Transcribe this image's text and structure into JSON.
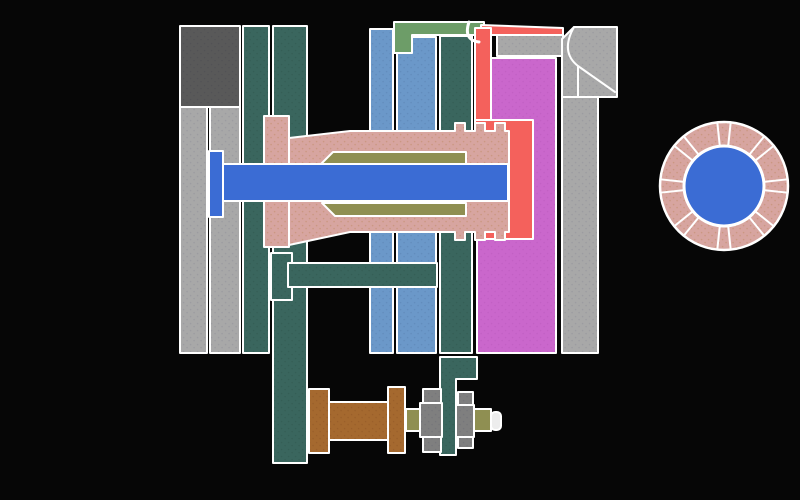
{
  "window": {
    "width": 800,
    "height": 500,
    "background": "#060606"
  },
  "palette": {
    "outline": "#ffffff",
    "dgray": "#595959",
    "lgray": "#a8a8a8",
    "teal": "#3a665e",
    "panelblue": "#6b98c9",
    "shaftblue": "#3b6cd4",
    "pink": "#d7a5a0",
    "olive": "#8f8f52",
    "green": "#6d9d68",
    "red": "#f4615c",
    "magenta": "#ca67cc",
    "brown": "#a5692f",
    "nutgray": "#7f7f7f",
    "darkred": "#330404",
    "cap": "#ededed",
    "circlepink": "#d7a5a0"
  },
  "texture_dots": {
    "pink": "#c08a64",
    "circlepink": "#c08a64",
    "lgray": "#8f8f98",
    "dgray": "#4b4b52",
    "teal": "#2f554d",
    "panelblue": "#5a82b2",
    "magenta": "#b95abb",
    "brown": "#8f5526",
    "nutgray": "#6e6e76"
  },
  "legend": {
    "name": "legend-box",
    "x": 9,
    "y": 17,
    "w": 88,
    "h": 49,
    "fill": "darkred",
    "stroke_width": 3
  },
  "cross_section": {
    "name": "mold-cross-section",
    "shapes": [
      {
        "name": "top-clamp-block",
        "fill": "dgray",
        "rect": [
          180,
          26,
          60,
          81
        ]
      },
      {
        "name": "back-plate-outer",
        "fill": "lgray",
        "rect": [
          180,
          107,
          27,
          246
        ]
      },
      {
        "name": "back-plate-inner",
        "fill": "lgray",
        "rect": [
          210,
          107,
          30,
          246
        ]
      },
      {
        "name": "riser-pillar-left",
        "fill": "teal",
        "rect": [
          243,
          26,
          26,
          327
        ]
      },
      {
        "name": "riser-pillar-mid",
        "fill": "teal",
        "rect": [
          273,
          26,
          34,
          437
        ]
      },
      {
        "name": "manifold-plate-left",
        "fill": "panelblue",
        "rect": [
          370,
          29,
          23,
          324
        ]
      },
      {
        "name": "manifold-plate-right",
        "fill": "panelblue",
        "rect": [
          397,
          37,
          39,
          316
        ]
      },
      {
        "name": "nozzle-retainer-column",
        "fill": "teal",
        "rect": [
          440,
          36,
          32,
          317
        ]
      },
      {
        "name": "top-seal-bar",
        "fill": "green",
        "poly": [
          [
            394,
            22
          ],
          [
            484,
            22
          ],
          [
            484,
            35
          ],
          [
            412,
            35
          ],
          [
            412,
            53
          ],
          [
            394,
            53
          ]
        ]
      },
      {
        "name": "top-gray-band",
        "fill": "lgray",
        "rect": [
          497,
          35,
          66,
          21
        ]
      },
      {
        "name": "cavity-plate",
        "fill": "magenta",
        "poly": [
          [
            491,
            58
          ],
          [
            556,
            58
          ],
          [
            556,
            353
          ],
          [
            477,
            353
          ],
          [
            477,
            237
          ],
          [
            491,
            237
          ]
        ]
      },
      {
        "name": "clamp-corner-block",
        "fill": "lgray",
        "poly": [
          [
            574,
            27
          ],
          [
            617,
            27
          ],
          [
            617,
            97
          ],
          [
            562,
            97
          ],
          [
            562,
            39
          ]
        ]
      },
      {
        "name": "right-mounting-plate",
        "fill": "lgray",
        "rect": [
          562,
          97,
          36,
          256
        ]
      },
      {
        "name": "corner-detail-line",
        "fill": null,
        "path": "M574,27 Q560,52 578,66 L615,92 M578,66 L578,97",
        "stroke_width": 2
      },
      {
        "name": "melt-channel-top",
        "fill": "red",
        "poly": [
          [
            481,
            25
          ],
          [
            563,
            28
          ],
          [
            563,
            35
          ],
          [
            481,
            35
          ]
        ]
      },
      {
        "name": "melt-channel-down",
        "fill": "red",
        "rect": [
          475,
          28,
          16,
          100
        ]
      },
      {
        "name": "melt-pocket",
        "fill": "red",
        "rect": [
          475,
          120,
          58,
          119
        ]
      },
      {
        "name": "channel-hook-line",
        "fill": null,
        "path": "M469,22 Q463,40 479,42",
        "stroke_width": 3
      },
      {
        "name": "nozzle-flange",
        "fill": "pink",
        "rect": [
          264,
          116,
          25,
          131
        ]
      },
      {
        "name": "nozzle-body",
        "fill": "pink",
        "poly": [
          [
            289,
            138
          ],
          [
            350,
            131
          ],
          [
            455,
            131
          ],
          [
            455,
            123
          ],
          [
            465,
            123
          ],
          [
            465,
            131
          ],
          [
            475,
            131
          ],
          [
            475,
            123
          ],
          [
            485,
            123
          ],
          [
            485,
            131
          ],
          [
            495,
            131
          ],
          [
            495,
            123
          ],
          [
            505,
            123
          ],
          [
            505,
            131
          ],
          [
            509,
            131
          ],
          [
            509,
            232
          ],
          [
            505,
            232
          ],
          [
            505,
            240
          ],
          [
            495,
            240
          ],
          [
            495,
            232
          ],
          [
            485,
            232
          ],
          [
            485,
            240
          ],
          [
            475,
            240
          ],
          [
            475,
            232
          ],
          [
            465,
            232
          ],
          [
            465,
            240
          ],
          [
            455,
            240
          ],
          [
            455,
            232
          ],
          [
            350,
            232
          ],
          [
            289,
            245
          ]
        ]
      },
      {
        "name": "liner-upper",
        "fill": "olive",
        "poly": [
          [
            320,
            165
          ],
          [
            333,
            152
          ],
          [
            466,
            152
          ],
          [
            466,
            165
          ]
        ]
      },
      {
        "name": "liner-lower",
        "fill": "olive",
        "poly": [
          [
            322,
            203
          ],
          [
            466,
            203
          ],
          [
            466,
            216
          ],
          [
            335,
            216
          ]
        ]
      },
      {
        "name": "core-rod",
        "fill": "shaftblue",
        "rect": [
          222,
          164,
          286,
          37
        ]
      },
      {
        "name": "core-rod-head",
        "fill": "shaftblue",
        "rect": [
          209,
          151,
          14,
          66
        ]
      },
      {
        "name": "guide-boss",
        "fill": "teal",
        "rect": [
          271,
          253,
          21,
          47
        ]
      },
      {
        "name": "ejector-crossbar",
        "fill": "teal",
        "rect": [
          288,
          263,
          149,
          24
        ]
      },
      {
        "name": "ejector-bracket",
        "fill": "teal",
        "poly": [
          [
            440,
            357
          ],
          [
            477,
            357
          ],
          [
            477,
            379
          ],
          [
            456,
            379
          ],
          [
            456,
            455
          ],
          [
            440,
            455
          ]
        ]
      },
      {
        "name": "spacer-flange-left",
        "fill": "brown",
        "rect": [
          309,
          389,
          20,
          64
        ]
      },
      {
        "name": "spacer-tube",
        "fill": "brown",
        "rect": [
          329,
          402,
          59,
          38
        ]
      },
      {
        "name": "spacer-flange-right",
        "fill": "brown",
        "rect": [
          388,
          387,
          17,
          66
        ]
      },
      {
        "name": "washer-left",
        "fill": "olive",
        "rect": [
          406,
          409,
          15,
          22
        ]
      },
      {
        "name": "nut-left-top",
        "fill": "nutgray",
        "rect": [
          423,
          389,
          18,
          14
        ]
      },
      {
        "name": "nut-left-mid",
        "fill": "nutgray",
        "rect": [
          420,
          403,
          22,
          34
        ]
      },
      {
        "name": "nut-left-bottom",
        "fill": "nutgray",
        "rect": [
          423,
          437,
          18,
          15
        ]
      },
      {
        "name": "nut-right-top",
        "fill": "nutgray",
        "rect": [
          458,
          392,
          15,
          13
        ]
      },
      {
        "name": "nut-right-mid",
        "fill": "nutgray",
        "rect": [
          456,
          405,
          18,
          32
        ]
      },
      {
        "name": "nut-right-bottom",
        "fill": "nutgray",
        "rect": [
          458,
          437,
          15,
          11
        ]
      },
      {
        "name": "washer-right",
        "fill": "olive",
        "rect": [
          474,
          409,
          17,
          22
        ]
      },
      {
        "name": "rod-end-cap",
        "fill": "cap",
        "rect": [
          491,
          412,
          10,
          18
        ],
        "rx": 4
      }
    ]
  },
  "front_view": {
    "name": "ring-front-view",
    "cx": 724,
    "cy": 186,
    "outer_r": 64,
    "hub_r": 40,
    "ring_fill": "circlepink",
    "hub_fill": "shaftblue",
    "key_angles_deg": [
      0,
      45,
      90,
      135,
      180,
      225,
      270,
      315
    ],
    "key_half_width_deg": 6
  }
}
